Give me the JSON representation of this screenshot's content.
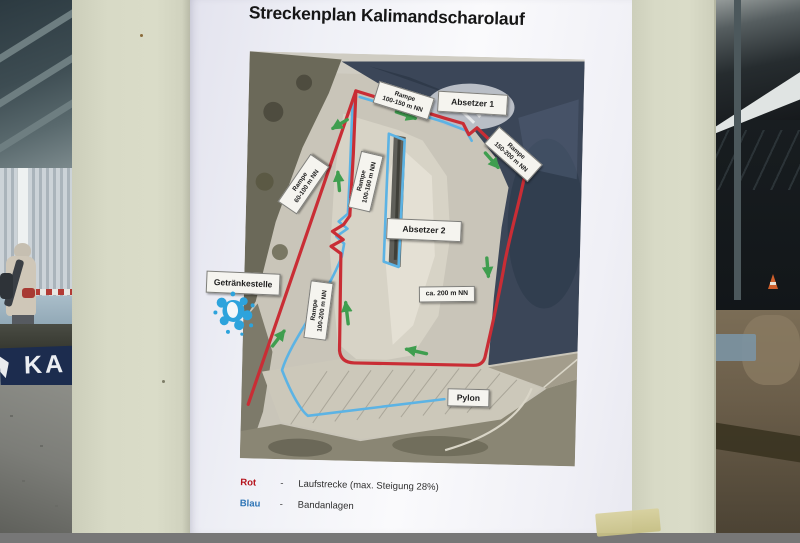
{
  "scene": {
    "banner_text": "KA"
  },
  "poster": {
    "title": "Streckenplan Kalimandscharolauf",
    "labels": {
      "rampe_100_150": {
        "line1": "Rampe",
        "line2": "100-150 m NN"
      },
      "rampe_150_200": {
        "line1": "Rampe",
        "line2": "150-200 m NN"
      },
      "rampe_60_100": {
        "line1": "Rampe",
        "line2": "60-100 m NN"
      },
      "rampe_100_160": {
        "line1": "Rampe",
        "line2": "100-160 m NN"
      },
      "rampe_100_200": {
        "line1": "Rampe",
        "line2": "100-200 m NN"
      },
      "absetzer_1": "Absetzer 1",
      "absetzer_2": "Absetzer 2",
      "getraenkestelle": "Getränkestelle",
      "ca_200": "ca. 200 m NN",
      "pylon": "Pylon"
    },
    "legend": {
      "rows": [
        {
          "term": "Rot",
          "separator": "-",
          "description": "Laufstrecke (max. Steigung 28%)"
        },
        {
          "term": "Blau",
          "separator": "-",
          "description": "Bandanlagen"
        }
      ]
    },
    "colors": {
      "route_red": "#c92d35",
      "conveyor_blue": "#5cb3e4",
      "arrow_green": "#3f9e4f",
      "legend_rot": "#b5121b",
      "legend_blau": "#2e75b6"
    }
  }
}
